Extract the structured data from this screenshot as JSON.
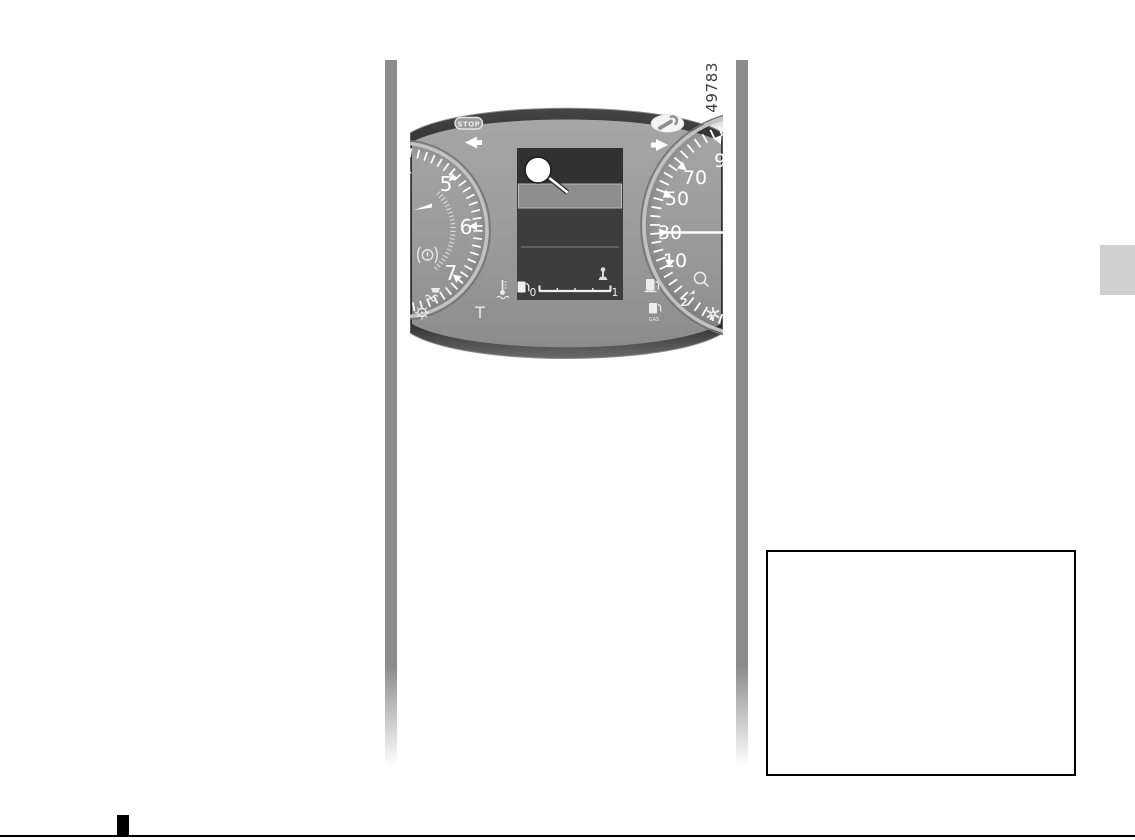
{
  "page": {
    "figure_number": "49783"
  },
  "cluster": {
    "stop_label": "STOP",
    "gas_label": "GAS",
    "left_dial": {
      "type": "tachometer",
      "numbers": [
        "4",
        "5",
        "6",
        "7"
      ],
      "t_label": "T"
    },
    "right_dial": {
      "type": "speedometer",
      "numbers": [
        "9",
        "70",
        "50",
        "30",
        "10"
      ],
      "needle_at": "30"
    },
    "display": {
      "callout_label": "",
      "fuel_min": "0",
      "fuel_max": "1"
    },
    "icons": [
      "stop-badge",
      "service-wrench-icon",
      "left-turn-indicator-arrow",
      "right-turn-indicator-arrow",
      "tachometer-needle-icon",
      "brake-warning-icon",
      "coolant-warning-icon",
      "light-warning-icon",
      "coolant-temperature-icon",
      "fuel-pump-icon",
      "gas-pump-icon",
      "gear-shift-indicator-icon",
      "speed-limiter-icon",
      "esc-warning-icon",
      "fuel-gauge-pump-icon",
      "fuel-nozzle-icon",
      "callout-marker"
    ]
  },
  "colors": {
    "body_gray": "#9b9b9b",
    "rim_dark": "#333333",
    "display_dark": "#3d3d3d",
    "highlight_band": "#8e8e8e",
    "page_bar_gray": "#8c8c8c",
    "side_tab_gray": "#d0d0d0",
    "ink": "#000000",
    "white": "#ffffff"
  }
}
